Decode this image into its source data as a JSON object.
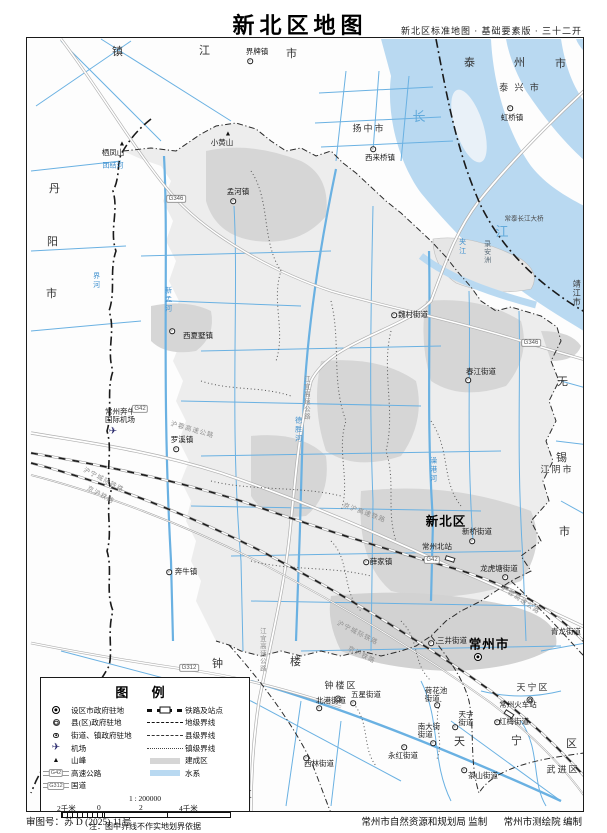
{
  "title": "新北区地图",
  "subtitle": "新北区标准地图 · 基础要素版 · 三十二开",
  "footer": {
    "review_no": "审图号：苏 D (2025) 11号",
    "supervisor": "常州市自然资源和规划局  监制",
    "producer": "常州市测绘院  编制"
  },
  "legend": {
    "title": "图 例",
    "left_items": [
      {
        "label": "设区市政府驻地",
        "sym": "city"
      },
      {
        "label": "县(区)政府驻地",
        "sym": "county"
      },
      {
        "label": "街道、镇政府驻地",
        "sym": "town"
      },
      {
        "label": "机场",
        "sym": "airport"
      },
      {
        "label": "山峰",
        "sym": "mountain"
      },
      {
        "label": "高速公路",
        "sym": "expressway",
        "badge": "G42"
      },
      {
        "label": "国道",
        "sym": "national-road",
        "badge": "G312"
      }
    ],
    "right_items": [
      {
        "label": "铁路及站点",
        "sym": "railway"
      },
      {
        "label": "地级界线",
        "sym": "prefecture-boundary"
      },
      {
        "label": "县级界线",
        "sym": "county-boundary"
      },
      {
        "label": "镇级界线",
        "sym": "town-boundary"
      },
      {
        "label": "建成区",
        "sym": "built-up-area"
      },
      {
        "label": "水系",
        "sym": "water-system"
      }
    ],
    "scale_text": "1 : 200000",
    "scale_bar": {
      "left": "2千米",
      "zero": "0",
      "mid": "2",
      "right": "4千米"
    },
    "note": "注：图中界线不作实地划界依据"
  },
  "colors": {
    "water_fill": "#b9d9f1",
    "water_line": "#6ab1e2",
    "district_fill": "#ededed",
    "builtup_fill": "#d6d6d6",
    "boundary": "#1a1a1a",
    "road_casing": "#b0b0b0",
    "river_text": "#3d8fce",
    "road_text": "#8f8f8f"
  },
  "map": {
    "labels": [
      {
        "t": "镇",
        "x": 118,
        "y": 53,
        "k": "city"
      },
      {
        "t": "江",
        "x": 205,
        "y": 52,
        "k": "city"
      },
      {
        "t": "市",
        "x": 292,
        "y": 55,
        "k": "city"
      },
      {
        "t": "泰",
        "x": 470,
        "y": 64,
        "k": "city"
      },
      {
        "t": "州",
        "x": 520,
        "y": 64,
        "k": "city"
      },
      {
        "t": "市",
        "x": 561,
        "y": 65,
        "k": "city"
      },
      {
        "t": "泰 兴 市",
        "x": 520,
        "y": 88,
        "k": "city2"
      },
      {
        "t": "扬中市",
        "x": 369,
        "y": 129,
        "k": "city2"
      },
      {
        "t": "丹",
        "x": 55,
        "y": 190,
        "k": "city"
      },
      {
        "t": "阳",
        "x": 53,
        "y": 243,
        "k": "city"
      },
      {
        "t": "市",
        "x": 52,
        "y": 295,
        "k": "city"
      },
      {
        "t": "靖江市",
        "x": 576,
        "y": 293,
        "k": "cityv"
      },
      {
        "t": "江阴市",
        "x": 557,
        "y": 470,
        "k": "city2"
      },
      {
        "t": "无",
        "x": 563,
        "y": 383,
        "k": "city"
      },
      {
        "t": "锡",
        "x": 562,
        "y": 459,
        "k": "city"
      },
      {
        "t": "市",
        "x": 565,
        "y": 533,
        "k": "city"
      },
      {
        "t": "武 进 区",
        "x": 233,
        "y": 795,
        "k": "city2"
      },
      {
        "t": "武进区",
        "x": 563,
        "y": 770,
        "k": "city2"
      },
      {
        "t": "天宁区",
        "x": 533,
        "y": 688,
        "k": "city2"
      },
      {
        "t": "天",
        "x": 460,
        "y": 743,
        "k": "city"
      },
      {
        "t": "宁",
        "x": 517,
        "y": 742,
        "k": "city"
      },
      {
        "t": "区",
        "x": 572,
        "y": 745,
        "k": "city"
      },
      {
        "t": "钟楼区",
        "x": 341,
        "y": 686,
        "k": "city2"
      },
      {
        "t": "钟",
        "x": 218,
        "y": 665,
        "k": "city"
      },
      {
        "t": "楼",
        "x": 296,
        "y": 663,
        "k": "city"
      },
      {
        "t": "常州市",
        "x": 489,
        "y": 645,
        "k": "cap"
      },
      {
        "t": "新北区",
        "x": 446,
        "y": 522,
        "k": "cap"
      },
      {
        "t": "界牌镇",
        "x": 257,
        "y": 52,
        "k": "town"
      },
      {
        "t": "虹桥镇",
        "x": 512,
        "y": 118,
        "k": "town"
      },
      {
        "t": "西来桥镇",
        "x": 380,
        "y": 158,
        "k": "town"
      },
      {
        "t": "小黄山",
        "x": 222,
        "y": 143,
        "k": "town"
      },
      {
        "t": "栖凤山",
        "x": 113,
        "y": 153,
        "k": "town"
      },
      {
        "t": "孟河镇",
        "x": 238,
        "y": 192,
        "k": "town"
      },
      {
        "t": "西夏墅镇",
        "x": 198,
        "y": 336,
        "k": "town"
      },
      {
        "t": "罗溪镇",
        "x": 182,
        "y": 440,
        "k": "town"
      },
      {
        "t": "奔牛镇",
        "x": 186,
        "y": 572,
        "k": "town"
      },
      {
        "t": "薛家镇",
        "x": 381,
        "y": 562,
        "k": "town"
      },
      {
        "t": "魏村街道",
        "x": 413,
        "y": 315,
        "k": "town"
      },
      {
        "t": "春江街道",
        "x": 481,
        "y": 372,
        "k": "town"
      },
      {
        "t": "新桥街道",
        "x": 477,
        "y": 532,
        "k": "town"
      },
      {
        "t": "龙虎塘街道",
        "x": 499,
        "y": 569,
        "k": "town"
      },
      {
        "t": "常州北站",
        "x": 437,
        "y": 547,
        "k": "town"
      },
      {
        "t": "常州火车站",
        "x": 518,
        "y": 705,
        "k": "town"
      },
      {
        "t": "三井街道",
        "x": 452,
        "y": 641,
        "k": "town"
      },
      {
        "t": "红梅街道",
        "x": 514,
        "y": 722,
        "k": "town"
      },
      {
        "t": "茶山街道",
        "x": 483,
        "y": 776,
        "k": "town"
      },
      {
        "t": "永红街道",
        "x": 403,
        "y": 756,
        "k": "town"
      },
      {
        "t": "南大街\n街道",
        "x": 429,
        "y": 731,
        "k": "town"
      },
      {
        "t": "五星街道",
        "x": 366,
        "y": 695,
        "k": "town"
      },
      {
        "t": "北港街道",
        "x": 331,
        "y": 701,
        "k": "town"
      },
      {
        "t": "西林街道",
        "x": 319,
        "y": 764,
        "k": "town"
      },
      {
        "t": "荷花池\n街道",
        "x": 436,
        "y": 695,
        "k": "town"
      },
      {
        "t": "天宁\n街道",
        "x": 466,
        "y": 719,
        "k": "town"
      },
      {
        "t": "青龙街道",
        "x": 566,
        "y": 632,
        "k": "town"
      },
      {
        "t": "常州奔牛\n国际机场",
        "x": 120,
        "y": 416,
        "k": "town"
      },
      {
        "t": "长",
        "x": 420,
        "y": 117,
        "k": "waterbig"
      },
      {
        "t": "江",
        "x": 503,
        "y": 232,
        "k": "waterbig"
      },
      {
        "t": "夹江",
        "x": 462,
        "y": 247,
        "k": "riverv"
      },
      {
        "t": "录安洲",
        "x": 487,
        "y": 252,
        "k": "islandv"
      },
      {
        "t": "团结河",
        "x": 113,
        "y": 166,
        "k": "river"
      },
      {
        "t": "界河",
        "x": 96,
        "y": 281,
        "k": "riverv"
      },
      {
        "t": "新孟河",
        "x": 168,
        "y": 300,
        "k": "riverv"
      },
      {
        "t": "德胜河",
        "x": 298,
        "y": 430,
        "k": "riverv"
      },
      {
        "t": "澡港河",
        "x": 433,
        "y": 470,
        "k": "riverv"
      },
      {
        "t": "常泰长江大桥",
        "x": 524,
        "y": 220,
        "k": "bridge"
      },
      {
        "t": "沪蓉高速公路",
        "x": 192,
        "y": 431,
        "k": "road",
        "rot": 16
      },
      {
        "t": "沪蓉高速公路",
        "x": 520,
        "y": 601,
        "k": "road",
        "rot": 34
      },
      {
        "t": "江宜高速公路",
        "x": 305,
        "y": 398,
        "k": "roadv"
      },
      {
        "t": "江宜高速公路",
        "x": 261,
        "y": 650,
        "k": "roadv"
      },
      {
        "t": "京沪高速铁路",
        "x": 364,
        "y": 514,
        "k": "road",
        "rot": 20
      },
      {
        "t": "沪宁城际铁路",
        "x": 103,
        "y": 481,
        "k": "road",
        "rot": 28
      },
      {
        "t": "京沪铁路",
        "x": 100,
        "y": 496,
        "k": "road",
        "rot": 28
      },
      {
        "t": "沪宁城际铁路",
        "x": 357,
        "y": 634,
        "k": "road",
        "rot": 27
      },
      {
        "t": "京沪铁路",
        "x": 361,
        "y": 656,
        "k": "road",
        "rot": 27
      },
      {
        "t": "G42",
        "x": 140,
        "y": 409,
        "k": "badge"
      },
      {
        "t": "G42",
        "x": 432,
        "y": 560,
        "k": "badge"
      },
      {
        "t": "G346",
        "x": 176,
        "y": 199,
        "k": "badge"
      },
      {
        "t": "G346",
        "x": 531,
        "y": 343,
        "k": "badge"
      },
      {
        "t": "G312",
        "x": 189,
        "y": 668,
        "k": "badge"
      }
    ],
    "symbols": [
      {
        "k": "city",
        "x": 478,
        "y": 657
      },
      {
        "k": "county",
        "x": 338,
        "y": 699
      },
      {
        "k": "county",
        "x": 530,
        "y": 700
      },
      {
        "k": "town",
        "x": 250,
        "y": 61
      },
      {
        "k": "town",
        "x": 510,
        "y": 108
      },
      {
        "k": "town",
        "x": 373,
        "y": 149
      },
      {
        "k": "town",
        "x": 233,
        "y": 201
      },
      {
        "k": "town",
        "x": 172,
        "y": 331
      },
      {
        "k": "town",
        "x": 176,
        "y": 449
      },
      {
        "k": "town",
        "x": 169,
        "y": 572
      },
      {
        "k": "town",
        "x": 366,
        "y": 562
      },
      {
        "k": "town",
        "x": 468,
        "y": 380
      },
      {
        "k": "town",
        "x": 394,
        "y": 315
      },
      {
        "k": "town",
        "x": 472,
        "y": 541
      },
      {
        "k": "town",
        "x": 505,
        "y": 577
      },
      {
        "k": "town",
        "x": 431,
        "y": 643
      },
      {
        "k": "town",
        "x": 497,
        "y": 722
      },
      {
        "k": "town",
        "x": 464,
        "y": 770
      },
      {
        "k": "town",
        "x": 404,
        "y": 747
      },
      {
        "k": "town",
        "x": 433,
        "y": 743
      },
      {
        "k": "town",
        "x": 353,
        "y": 703
      },
      {
        "k": "town",
        "x": 319,
        "y": 708
      },
      {
        "k": "town",
        "x": 306,
        "y": 758
      },
      {
        "k": "town",
        "x": 437,
        "y": 705
      },
      {
        "k": "town",
        "x": 455,
        "y": 727
      },
      {
        "k": "mountain",
        "x": 228,
        "y": 134
      },
      {
        "k": "mountain",
        "x": 122,
        "y": 144
      },
      {
        "k": "airport",
        "x": 113,
        "y": 432
      },
      {
        "k": "station",
        "x": 450,
        "y": 559,
        "rot": 18
      },
      {
        "k": "station",
        "x": 509,
        "y": 714,
        "rot": 33
      }
    ]
  }
}
